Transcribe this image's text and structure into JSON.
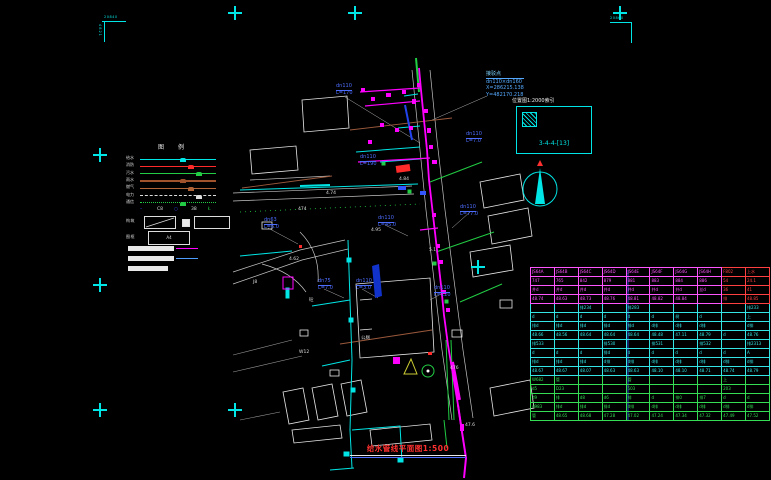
{
  "colors": {
    "cyan": "#00E5E5",
    "magenta": "#FF00FF",
    "green": "#22CC44",
    "red": "#FF2A2A",
    "blue": "#3355FF",
    "brown": "#9C5A3C",
    "white": "#E8E8E8"
  },
  "frame": {
    "corner_tl_top": "20840",
    "corner_tl_side": "4821",
    "corner_tr_top": "20860"
  },
  "legend": {
    "title": "图例",
    "rows": [
      {
        "label": "给水",
        "color": "#00E5E5",
        "style": "solid"
      },
      {
        "label": "消防",
        "color": "#FF2A2A",
        "style": "solid"
      },
      {
        "label": "污水",
        "color": "#22CC44",
        "style": "solid"
      },
      {
        "label": "雨水",
        "color": "#A0522D",
        "style": "solid"
      },
      {
        "label": "燃气",
        "color": "#B06438",
        "style": "solid"
      },
      {
        "label": "电力",
        "color": "#DDDDDD",
        "style": "dashed"
      },
      {
        "label": "通信",
        "color": "#22CC44",
        "style": "dotted"
      }
    ],
    "symbols": [
      {
        "text": "–",
        "color": "#3355FF"
      },
      {
        "text": "C8",
        "color": "#DDDDDD"
      },
      {
        "text": "○",
        "color": "#3355FF"
      },
      {
        "text": "38",
        "color": "#DDDDDD"
      },
      {
        "text": "Ł",
        "color": "#22CC44"
      }
    ],
    "box_row_label": "构筑",
    "frame_row_label": "图框",
    "frame_box_text": "A4"
  },
  "detail_box": {
    "title": "位置图1:2000索引",
    "code": "3-4-4-[13]"
  },
  "connection_note": {
    "title": "接驳点",
    "size": "dn110×dn160",
    "x": "X=286215.138",
    "y": "Y=482170.218"
  },
  "drawing": {
    "pipe_labels": [
      {
        "d": "dn110",
        "l": "L=170",
        "x": 336,
        "y": 84
      },
      {
        "d": "dn110",
        "l": "L=7.0",
        "x": 466,
        "y": 132
      },
      {
        "d": "dn110",
        "l": "L=190",
        "x": 360,
        "y": 155
      },
      {
        "d": "dn63",
        "l": "L=6.0",
        "x": 264,
        "y": 218
      },
      {
        "d": "dn110",
        "l": "L=45.0",
        "x": 378,
        "y": 216
      },
      {
        "d": "dn110",
        "l": "L=77.0",
        "x": 460,
        "y": 205
      },
      {
        "d": "dn75",
        "l": "L=7.0",
        "x": 318,
        "y": 279
      },
      {
        "d": "dn110",
        "l": "L=3.0",
        "x": 356,
        "y": 279
      },
      {
        "d": "dn110",
        "l": "L=120",
        "x": 434,
        "y": 286
      }
    ],
    "tiny_labels": [
      {
        "t": "474",
        "x": 298,
        "y": 208
      },
      {
        "t": "476",
        "x": 450,
        "y": 367
      },
      {
        "t": "4.74",
        "x": 326,
        "y": 192
      },
      {
        "t": "4.84",
        "x": 399,
        "y": 178
      },
      {
        "t": "4.62",
        "x": 289,
        "y": 258
      },
      {
        "t": "47.6",
        "x": 465,
        "y": 424
      },
      {
        "t": "公厕",
        "x": 361,
        "y": 337
      },
      {
        "t": "4.95",
        "x": 371,
        "y": 229
      },
      {
        "t": "W12",
        "x": 299,
        "y": 351
      },
      {
        "t": "5.1",
        "x": 429,
        "y": 249
      },
      {
        "t": "J8",
        "x": 253,
        "y": 281
      },
      {
        "t": "砼",
        "x": 309,
        "y": 299
      }
    ]
  },
  "title_block": {
    "caption": "给水管线平面图1:500"
  },
  "table": {
    "groups": [
      {
        "color": "magenta",
        "red_cols": [
          8,
          9
        ],
        "rows": [
          [
            "JS64A",
            "JS64B",
            "JS64C",
            "JS64D",
            "JS64E",
            "JS64F",
            "JS64G",
            "JS64H",
            "F802",
            "上水"
          ],
          [
            "747",
            "765",
            "842",
            "879",
            "881",
            "883",
            "884",
            "886",
            "54",
            "24.1"
          ],
          [
            "井d",
            "井d",
            "井d",
            "井d",
            "井d",
            "井d",
            "井d",
            "丝d",
            "36",
            "41"
          ],
          [
            "48.74",
            "48.63",
            "48.73",
            "48.76",
            "48.81",
            "48.82",
            "48.84",
            "",
            "排",
            "48.85"
          ]
        ]
      },
      {
        "color": "cyan",
        "red_cols": [],
        "rows": [
          [
            "",
            "",
            "排234",
            "",
            "排283",
            "",
            "",
            "",
            "",
            "排233"
          ],
          [
            "d",
            "d",
            "d",
            "d",
            "d",
            "d",
            "树",
            "d",
            "",
            "上"
          ],
          [
            "排d",
            "排d",
            "排d",
            "排d",
            "排d",
            "d排",
            "d排",
            "d排",
            "",
            "d排"
          ],
          [
            "48.66",
            "48.56",
            "48.64",
            "48.64",
            "48.64",
            "48.48",
            "47.11",
            "48.79",
            "d",
            "48.76"
          ]
        ]
      },
      {
        "color": "cyan",
        "red_cols": [],
        "rows": [
          [
            "排533",
            "",
            "",
            "排530",
            "",
            "排531",
            "",
            "排532",
            "",
            "排2313"
          ],
          [
            "d",
            "d",
            "d",
            "排d",
            "d",
            "d",
            "d",
            "d",
            "d",
            "A"
          ],
          [
            "排d",
            "排d",
            "排d",
            "d排",
            "d排",
            "d排",
            "d排",
            "d排",
            "d排",
            "d排"
          ],
          [
            "48.67",
            "48.67",
            "48.07",
            "48.63",
            "48.63",
            "48.10",
            "48.10",
            "48.71",
            "48.74",
            "48.79"
          ]
        ]
      },
      {
        "color": "green",
        "red_cols": [],
        "rows": [
          [
            "W682",
            "管",
            "",
            "",
            "管",
            "",
            "",
            "",
            "上",
            ""
          ],
          [
            "d5",
            "D23",
            "",
            "",
            "503",
            "",
            "",
            "",
            "203",
            ""
          ],
          [
            "d9",
            "排",
            "d8",
            "d6",
            "排",
            "d",
            "排0",
            "排7",
            "d",
            "d"
          ],
          [
            "d983",
            "排d",
            "排d",
            "排d",
            "d排",
            "d排",
            "d排",
            "d排",
            "d排",
            "d排"
          ],
          [
            "管",
            "48.65",
            "48.68",
            "47.28",
            "47.02",
            "47.24",
            "47.34",
            "47.32",
            "47.49",
            "47.52"
          ]
        ]
      }
    ]
  }
}
